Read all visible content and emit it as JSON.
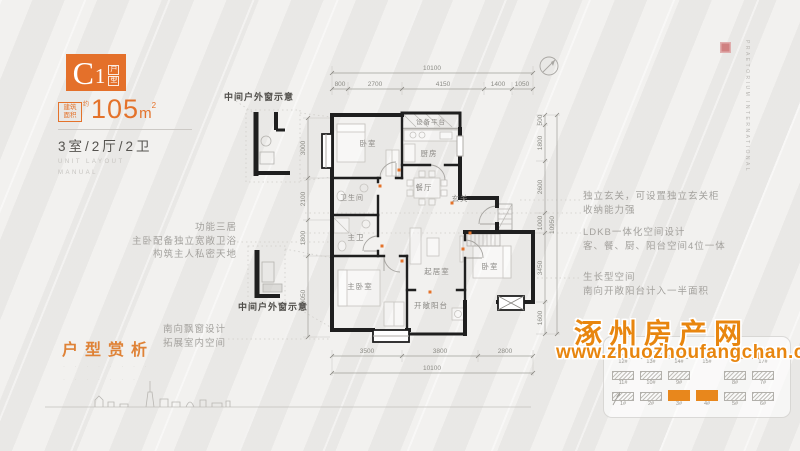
{
  "palette": {
    "accent": "#e4722a",
    "watermark_orange": "#e8860f",
    "wall": "#1f1f1f",
    "bg": "#edecea"
  },
  "panel": {
    "logo": {
      "letter": "C",
      "number": "1",
      "suffix1": "户",
      "suffix2": "型"
    },
    "area_tag_line1": "建筑",
    "area_tag_line2": "面积",
    "area_approx": "约",
    "area_value": "105",
    "area_unit": "m",
    "area_sup": "2",
    "rooms": "3室/2厅/2卫",
    "caption1": "UNIT LAYOUT",
    "caption2": "MANUAL",
    "section_title": "户型赏析",
    "faint1": "· · · · · · · ·",
    "faint2": "· · · ·  · · ·"
  },
  "plan": {
    "rooms": {
      "bedroom1": "卧室",
      "platform": "设备平台",
      "kitchen": "厨房",
      "dining": "餐厅",
      "foyer": "玄关",
      "bath": "卫生间",
      "master_bath": "主卫",
      "master": "主卧室",
      "living": "起居室",
      "bedroom2": "卧室",
      "balcony": "开敞阳台"
    },
    "dims": {
      "top_total": "10100",
      "top": [
        "800",
        "2700",
        "4150",
        "1400",
        "1050"
      ],
      "bottom": [
        "3500",
        "3800",
        "2800"
      ],
      "bottom_total": "10100",
      "left": [
        "3000",
        "2100",
        "1800",
        "4050"
      ],
      "right": [
        "500",
        "1800",
        "2600",
        "1000",
        "3450",
        "1600"
      ],
      "right_total": "10950"
    }
  },
  "annotations": {
    "detail_top": "中间户外窗示意",
    "detail_mid": "中间户外窗示意",
    "left1": [
      "功能三居",
      "主卧配备独立宽敞卫浴",
      "构筑主人私密天地"
    ],
    "left2": [
      "南向飘窗设计",
      "拓展室内空间"
    ],
    "right1": [
      "独立玄关，可设置独立玄关柜",
      "收纳能力强"
    ],
    "right2": [
      "LDKB一体化空间设计",
      "客、餐、厨、阳台空间4位一体"
    ],
    "right3": [
      "生长型空间",
      "南向开敞阳台计入一半面积"
    ]
  },
  "watermark": {
    "title": "涿州房产网",
    "url": "www.zhuozhoufangchan.com"
  },
  "siteplan": {
    "r1": [
      "12#",
      "13#",
      "14#",
      "15#",
      "16#",
      "17#"
    ],
    "r2": [
      "11#",
      "10#",
      "9#",
      "8#",
      "7#"
    ],
    "r3": [
      "1#",
      "2#",
      "3#",
      "4#",
      "5#",
      "6#"
    ]
  },
  "corner": {
    "en1": "PRAETORIUM",
    "en2": "INTERNATIONAL"
  }
}
